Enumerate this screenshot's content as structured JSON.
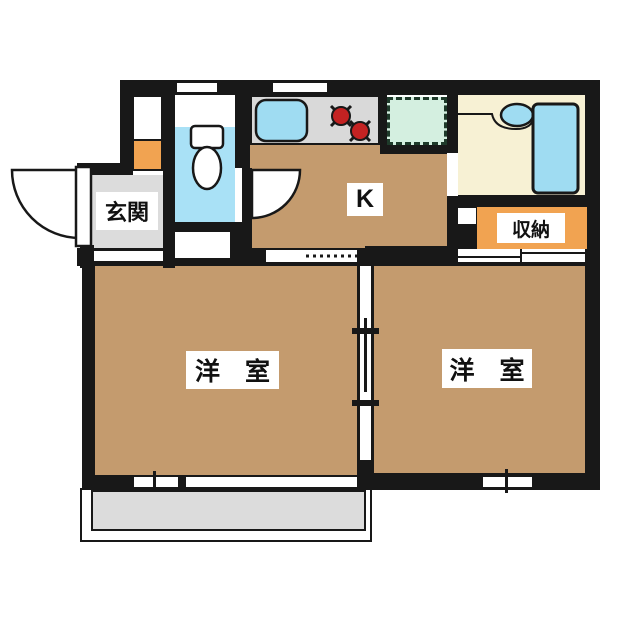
{
  "title": "apartment floor plan",
  "rooms": {
    "genkan": {
      "label": "玄関",
      "floor": "gray"
    },
    "kitchen": {
      "label": "K",
      "floor": "tan"
    },
    "storage": {
      "label": "収納",
      "floor": "orange"
    },
    "toilet": {
      "floor": "light-blue"
    },
    "bathroom": {
      "floor": "cream"
    },
    "room_left": {
      "label": "洋　室",
      "floor": "tan"
    },
    "room_right": {
      "label": "洋　室",
      "floor": "tan"
    }
  },
  "fixtures": {
    "toilet": "toilet",
    "kitchen_sink": "kitchen-sink",
    "stove": "two-burner-stove",
    "washer_space": "washing-machine-space",
    "wash_basin": "wash-basin",
    "bathtub": "bathtub",
    "entrance_door": "outward-swing-door",
    "kitchen_door": "inward-swing-door",
    "room_divider": "sliding-partition",
    "balcony": "balcony"
  },
  "colors": {
    "wall": "#181818",
    "tan": "#c49b6e",
    "grayfloor": "#dcdcdc",
    "counter": "#d9d9d9",
    "aqua": "#a9e1f6",
    "fixblue": "#9fdcf2",
    "cream": "#f7f1d4",
    "orange": "#f1a351",
    "green": "#d4efe0",
    "burner": "#c32222"
  }
}
